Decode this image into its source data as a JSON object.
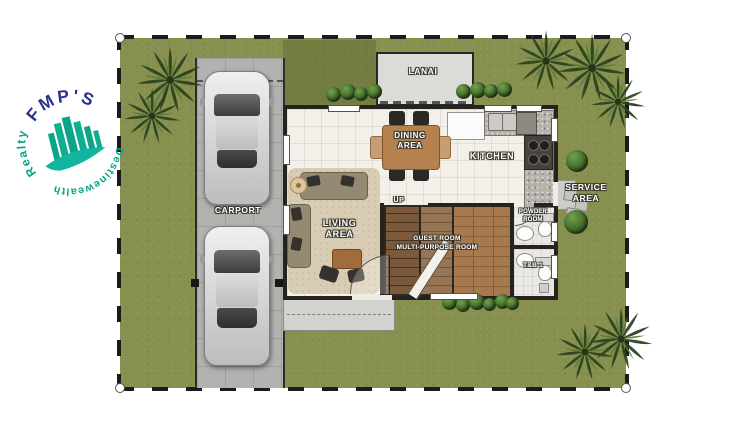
{
  "logo": {
    "brand": "FMP'S",
    "left_text": "Realty",
    "right_text": "Destinewealth"
  },
  "floor_plan": {
    "rooms": {
      "lanai": {
        "label": "LANAI"
      },
      "dining": {
        "line1": "DINING",
        "line2": "AREA"
      },
      "kitchen": {
        "label": "KITCHEN"
      },
      "service": {
        "line1": "SERVICE",
        "line2": "AREA"
      },
      "carport": {
        "label": "CARPORT"
      },
      "living": {
        "line1": "LIVING",
        "line2": "AREA"
      },
      "stairs": {
        "label": "UP"
      },
      "guest": {
        "line1": "GUEST ROOM",
        "line2": "MULTI-PURPOSE ROOM"
      },
      "powder": {
        "line1": "POWDER",
        "line2": "ROOM"
      },
      "toilet_bath": {
        "label": "T&B 1"
      }
    },
    "colors": {
      "grass": "#87904f",
      "concrete": "#b2b2b0",
      "interior_tile": "#f3f0e9",
      "wood_floor": "#a67a4c",
      "logo_teal": "#0aa487",
      "logo_navy": "#27318b"
    }
  }
}
